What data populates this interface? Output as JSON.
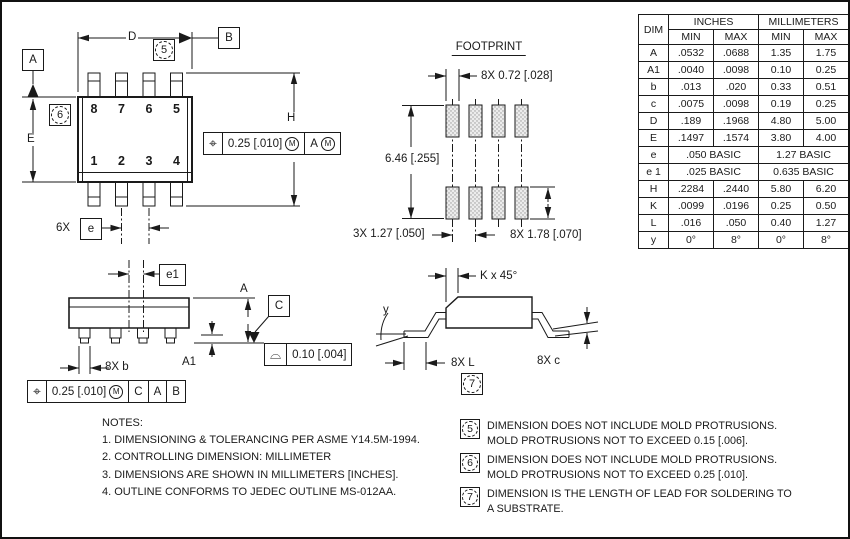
{
  "top_view": {
    "dim_d_label": "D",
    "datum_a": "A",
    "datum_b": "B",
    "note_flag_5": "5",
    "note_flag_6": "6",
    "dim_e_label": "E",
    "dim_h_label": "H",
    "pins_top": [
      "8",
      "7",
      "6",
      "5"
    ],
    "pins_bottom": [
      "1",
      "2",
      "3",
      "4"
    ],
    "pitch_count": "6X",
    "pitch_dim": "e",
    "fcf": {
      "symbol": "⌖",
      "tolerance": "0.25 [.010]",
      "modifier": "M",
      "datum": "A",
      "datum_modifier": "M"
    }
  },
  "footprint": {
    "title": "FOOTPRINT",
    "pad_width": "8X 0.72 [.028]",
    "row_span": "6.46 [.255]",
    "pitch": "3X 1.27 [.050]",
    "pad_height": "8X 1.78 [.070]"
  },
  "front_view": {
    "dim_e1": "e1",
    "dim_a": "A",
    "datum_c": "C",
    "dim_a1": "A1",
    "lead_width": "8X b",
    "flatness_fcf": {
      "symbol": "⌓",
      "tolerance": "0.10 [.004]"
    },
    "position_fcf": {
      "symbol": "⌖",
      "tolerance": "0.25 [.010]",
      "modifier": "M",
      "datum1": "C",
      "datum2": "A",
      "datum3": "B"
    }
  },
  "end_view": {
    "chamfer": "K x 45°",
    "lead_angle": "y",
    "lead_length": "8X L",
    "lead_thickness": "8X c",
    "note_flag_7": "7"
  },
  "table": {
    "dim_header": "DIM",
    "inches_header": "INCHES",
    "mm_header": "MILLIMETERS",
    "sub_headers": [
      "MIN",
      "MAX",
      "MIN",
      "MAX"
    ],
    "rows": [
      {
        "dim": "A",
        "vals": [
          ".0532",
          ".0688",
          "1.35",
          "1.75"
        ]
      },
      {
        "dim": "A1",
        "vals": [
          ".0040",
          ".0098",
          "0.10",
          "0.25"
        ]
      },
      {
        "dim": "b",
        "vals": [
          ".013",
          ".020",
          "0.33",
          "0.51"
        ]
      },
      {
        "dim": "c",
        "vals": [
          ".0075",
          ".0098",
          "0.19",
          "0.25"
        ]
      },
      {
        "dim": "D",
        "vals": [
          ".189",
          ".1968",
          "4.80",
          "5.00"
        ]
      },
      {
        "dim": "E",
        "vals": [
          ".1497",
          ".1574",
          "3.80",
          "4.00"
        ]
      },
      {
        "dim": "e",
        "vals": [
          ".050 BASIC",
          "1.27 BASIC"
        ]
      },
      {
        "dim": "e 1",
        "vals": [
          ".025 BASIC",
          "0.635 BASIC"
        ]
      },
      {
        "dim": "H",
        "vals": [
          ".2284",
          ".2440",
          "5.80",
          "6.20"
        ]
      },
      {
        "dim": "K",
        "vals": [
          ".0099",
          ".0196",
          "0.25",
          "0.50"
        ]
      },
      {
        "dim": "L",
        "vals": [
          ".016",
          ".050",
          "0.40",
          "1.27"
        ]
      },
      {
        "dim": "y",
        "vals": [
          "0°",
          "8°",
          "0°",
          "8°"
        ]
      }
    ]
  },
  "notes": {
    "title": "NOTES:",
    "items": [
      "1.  DIMENSIONING & TOLERANCING PER ASME Y14.5M-1994.",
      "2.  CONTROLLING DIMENSION: MILLIMETER",
      "3.  DIMENSIONS ARE SHOWN IN MILLIMETERS [INCHES].",
      "4.  OUTLINE CONFORMS TO JEDEC OUTLINE MS-012AA."
    ]
  },
  "flag_notes": [
    {
      "num": "5",
      "line1": "DIMENSION DOES NOT INCLUDE MOLD PROTRUSIONS.",
      "line2": "MOLD PROTRUSIONS NOT TO EXCEED 0.15 [.006]."
    },
    {
      "num": "6",
      "line1": "DIMENSION DOES NOT INCLUDE MOLD PROTRUSIONS.",
      "line2": "MOLD PROTRUSIONS NOT TO EXCEED 0.25 [.010]."
    },
    {
      "num": "7",
      "line1": "DIMENSION IS THE LENGTH OF LEAD FOR SOLDERING TO",
      "line2": "A SUBSTRATE."
    }
  ]
}
